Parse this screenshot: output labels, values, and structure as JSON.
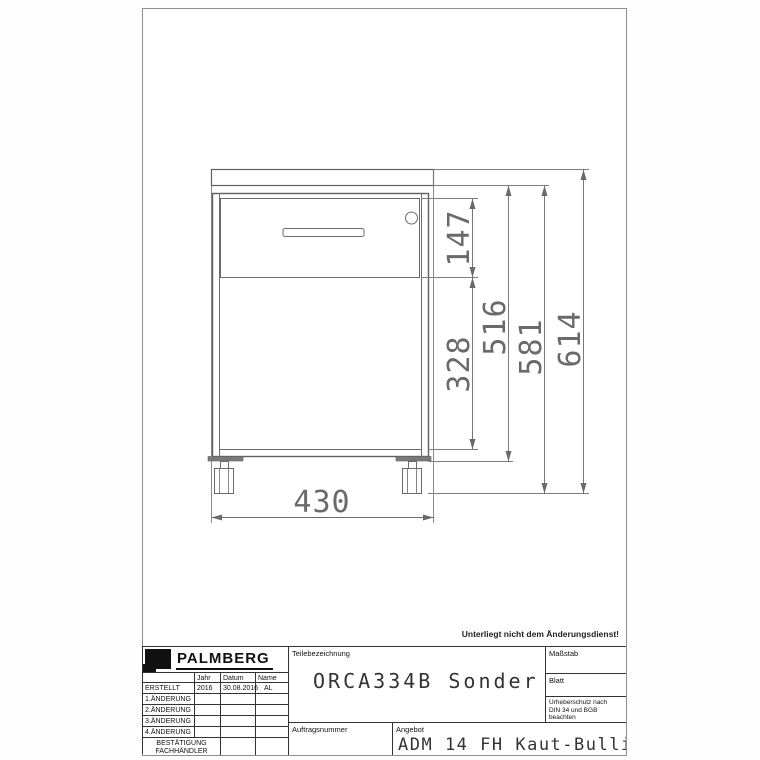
{
  "sheet": {
    "change_note": "Unterliegt nicht dem Änderungsdienst!"
  },
  "drawing": {
    "dimensions": {
      "width": "430",
      "drawer_front_height": "147",
      "lower_front_height": "328",
      "carcass_height": "516",
      "height_with_casters": "581",
      "overall_height": "614"
    }
  },
  "title_block": {
    "brand": "PALMBERG",
    "revision_table": {
      "col_jahr": "Jahr",
      "col_datum": "Datum",
      "col_name": "Name",
      "rows": [
        {
          "label": "ERSTELLT",
          "jahr": "2016",
          "datum": "30.08.2016",
          "name": "AL"
        },
        {
          "label": "1.ÄNDERUNG",
          "jahr": "",
          "datum": "",
          "name": ""
        },
        {
          "label": "2.ÄNDERUNG",
          "jahr": "",
          "datum": "",
          "name": ""
        },
        {
          "label": "3.ÄNDERUNG",
          "jahr": "",
          "datum": "",
          "name": ""
        },
        {
          "label": "4.ÄNDERUNG",
          "jahr": "",
          "datum": "",
          "name": ""
        }
      ],
      "confirmation_row": {
        "line1": "BESTÄTIGUNG",
        "line2": "FACHHÄNDLER"
      }
    },
    "teilebezeichnung": {
      "label": "Teilebezeichnung",
      "value": "ORCA334B Sonder"
    },
    "massstab_label": "Maßstab",
    "blatt_label": "Blatt",
    "copyright": {
      "line1": "Urheberschutz nach",
      "line2": "DIN 34 und BGB",
      "line3": "beachten"
    },
    "auftragsnummer_label": "Auftragsnummer",
    "angebot": {
      "label": "Angebot",
      "value": "ADM 14 FH Kaut-Bullinger"
    }
  }
}
